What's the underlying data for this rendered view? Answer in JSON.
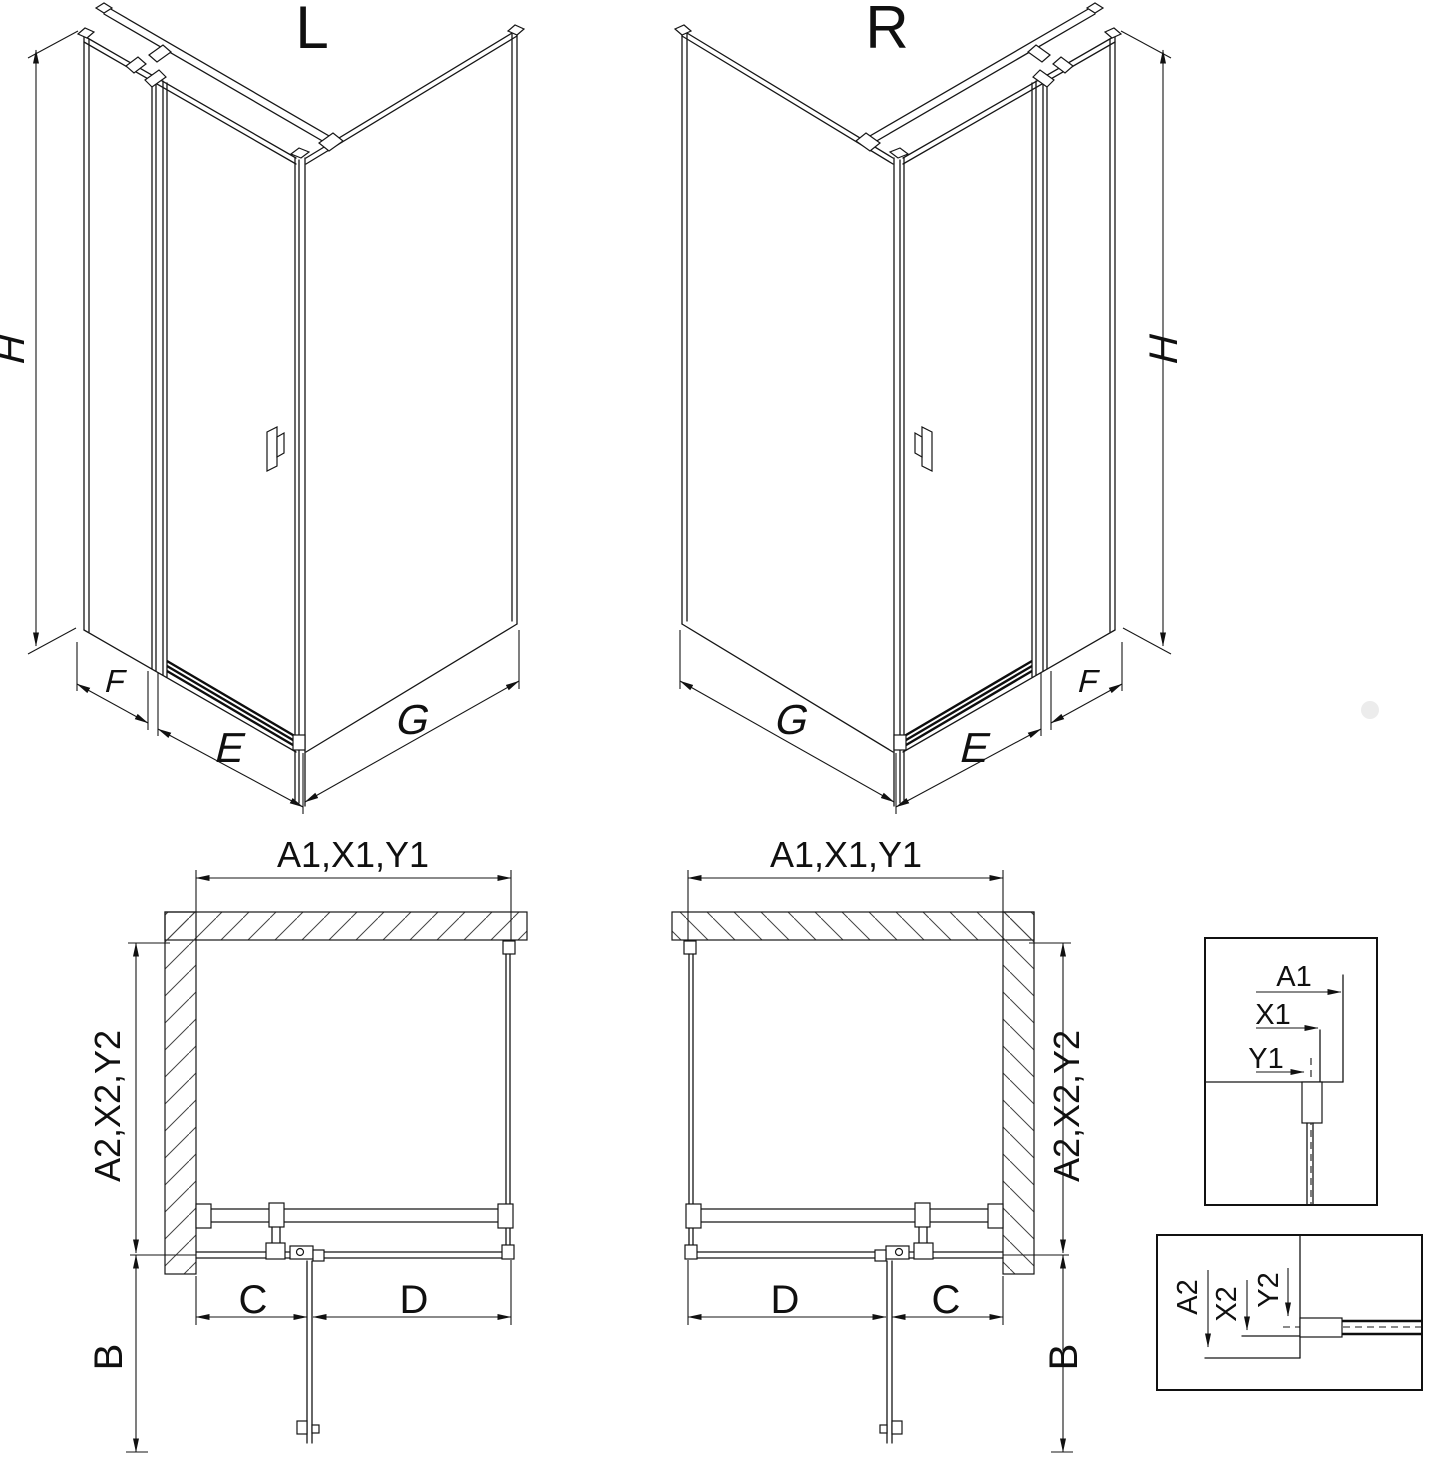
{
  "drawing": {
    "iso_left": {
      "label": "L",
      "height": "H",
      "panel_f": "F",
      "door_e": "E",
      "panel_g": "G"
    },
    "iso_right": {
      "label": "R",
      "height": "H",
      "panel_f": "F",
      "door_e": "E",
      "panel_g": "G"
    },
    "plan_left": {
      "width": "A1,X1,Y1",
      "depth": "A2,X2,Y2",
      "door_swing": "B",
      "c": "C",
      "d": "D"
    },
    "plan_right": {
      "width": "A1,X1,Y1",
      "depth": "A2,X2,Y2",
      "door_swing": "B",
      "c": "C",
      "d": "D"
    },
    "detail_horizontal": {
      "a1": "A1",
      "x1": "X1",
      "y1": "Y1"
    },
    "detail_vertical": {
      "a2": "A2",
      "x2": "X2",
      "y2": "Y2"
    }
  }
}
